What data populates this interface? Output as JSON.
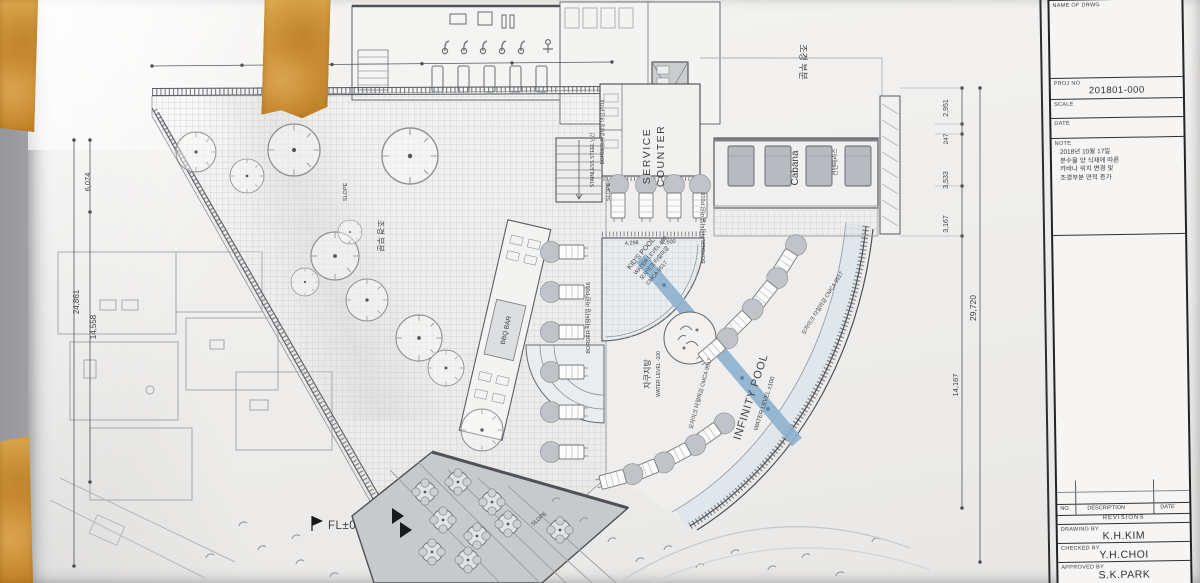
{
  "photo": {
    "wall_color": "#a9a9ad",
    "tape_color": "#cf9238",
    "paper_color": "#efeeec"
  },
  "title_block": {
    "name_of_drwg": {
      "label": "NAME OF DRWG"
    },
    "proj_no": {
      "label": "PROJ NO",
      "value": "201801-000"
    },
    "scale": {
      "label": "SCALE"
    },
    "date": {
      "label": "DATE"
    },
    "note": {
      "label": "NOTE",
      "lines": [
        "2018년 10월 17일",
        "분수물 양 식재에 따른",
        "카바나 위치 변경 및",
        "조경부분 면적 증가"
      ]
    },
    "revisions": {
      "no_label": "NO.",
      "description_label": "DESCRIPTION",
      "date_label": "DATE",
      "title": "REVISIONS"
    },
    "signoff": {
      "drawing_by_label": "DRAWING BY",
      "drawing_by": "K.H.KIM",
      "checked_by_label": "CHECKED BY",
      "checked_by": "Y.H.CHOI",
      "approved_by_label": "APPROVED BY",
      "approved_by": "S.K.PARK"
    }
  },
  "plan": {
    "labels": {
      "service_counter_line1": "SERVICE",
      "service_counter_line2": "COUNTER",
      "cabana": "Cabana",
      "cabana_korean": "선탠테라스",
      "infinity_pool": "INFINITY POOL",
      "infinity_pool_level": "WATER LEVEL ±100",
      "kids_pool": "KID'S POOL",
      "kids_pool_level": "WATER LEVEL 400",
      "kids_pool_finish1": "모자이크 타일마감",
      "kids_pool_finish2": "CMCA 9517",
      "jacuzzi": "자쿠지탕",
      "jacuzzi_level": "WATER LEVEL -100",
      "bbq_bar": "BBQ BAR",
      "stainless_rail": "STAINLESS STEEL 난간",
      "border_tile": "BORDER 자형타일 마감 P016",
      "mosaic_tile": "모자이크 타일마감 CMCA 9517",
      "landscape_zone": "조경 부분",
      "slope": "SLOPE",
      "level_marker": "FL±0"
    },
    "dimensions": {
      "left_overall": "24,861",
      "left_inner": "14,558",
      "left_top": "6,074",
      "right_overall": "29,720",
      "right_seg_1": "2,951",
      "right_seg_2": "247",
      "right_seg_3": "3,533",
      "right_seg_4": "3,167",
      "right_lower": "14,167",
      "pool_dim_1": "4,298",
      "pool_dim_2": "2,500"
    }
  }
}
